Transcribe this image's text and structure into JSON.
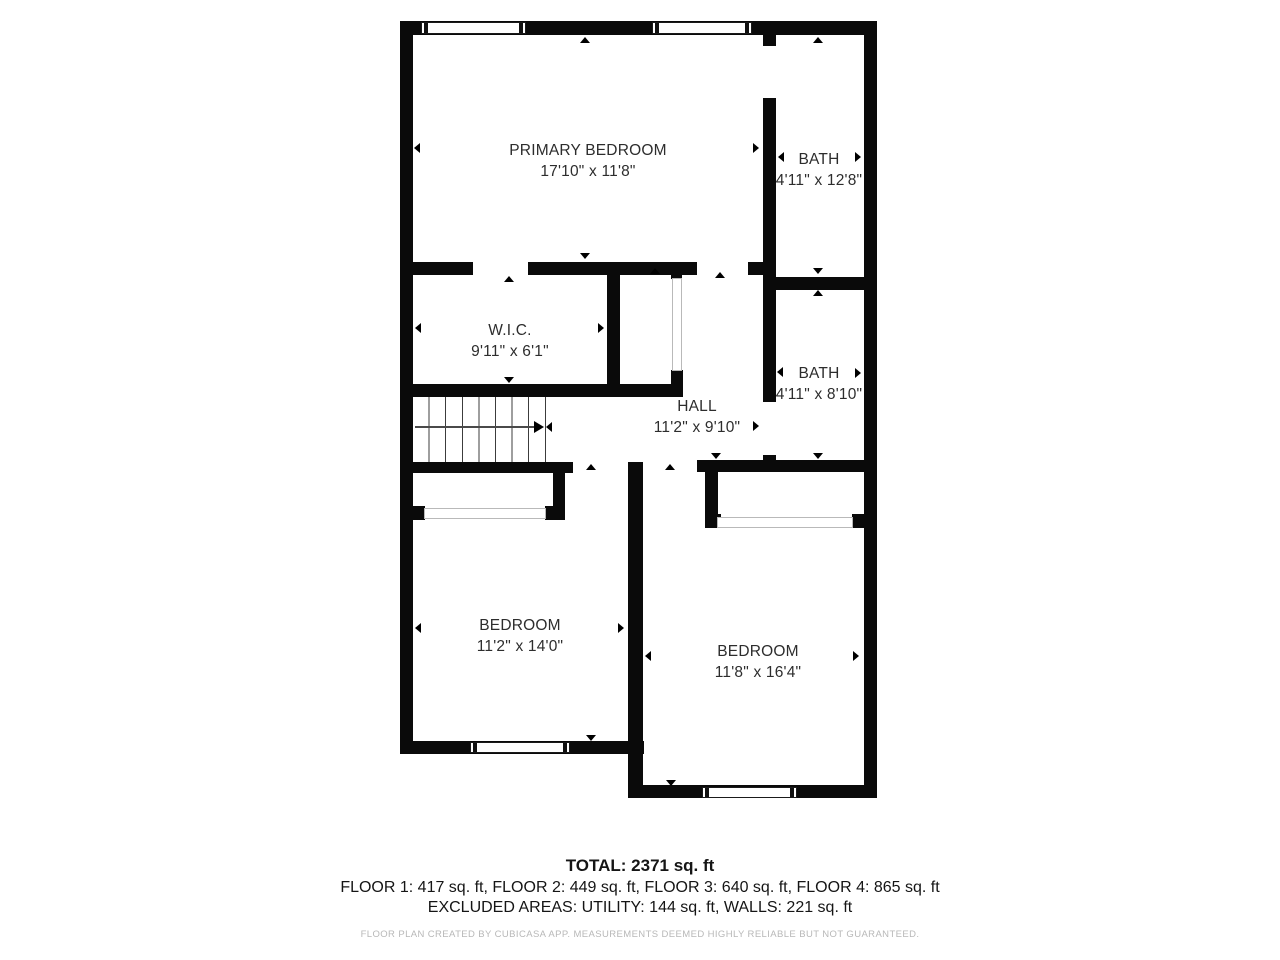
{
  "plan": {
    "rooms": [
      {
        "id": "primary-bedroom",
        "name": "PRIMARY BEDROOM",
        "dims": "17'10\" x 11'8\""
      },
      {
        "id": "bath-top",
        "name": "BATH",
        "dims": "4'11\" x 12'8\""
      },
      {
        "id": "wic",
        "name": "W.I.C.",
        "dims": "9'11\" x 6'1\""
      },
      {
        "id": "hall",
        "name": "HALL",
        "dims": "11'2\" x 9'10\""
      },
      {
        "id": "bath-mid",
        "name": "BATH",
        "dims": "4'11\" x 8'10\""
      },
      {
        "id": "bedroom-left",
        "name": "BEDROOM",
        "dims": "11'2\" x 14'0\""
      },
      {
        "id": "bedroom-right",
        "name": "BEDROOM",
        "dims": "11'8\" x 16'4\""
      }
    ],
    "features": [
      "staircase-with-up-arrow",
      "windows",
      "door-openings",
      "closet-sliding-doors"
    ]
  },
  "summary": {
    "total": "TOTAL: 2371 sq. ft",
    "floors": "FLOOR 1: 417 sq. ft, FLOOR 2: 449 sq. ft, FLOOR 3: 640 sq. ft, FLOOR 4: 865 sq. ft",
    "excluded": "EXCLUDED AREAS: UTILITY: 144 sq. ft, WALLS: 221 sq. ft",
    "disclaimer": "FLOOR PLAN CREATED BY CUBICASA APP. MEASUREMENTS DEEMED HIGHLY RELIABLE BUT NOT GUARANTEED."
  },
  "colors": {
    "wall": "#0a0a0a",
    "background": "#ffffff",
    "label_text": "#2d2d2d",
    "disclaimer_text": "#b8b8b8"
  }
}
